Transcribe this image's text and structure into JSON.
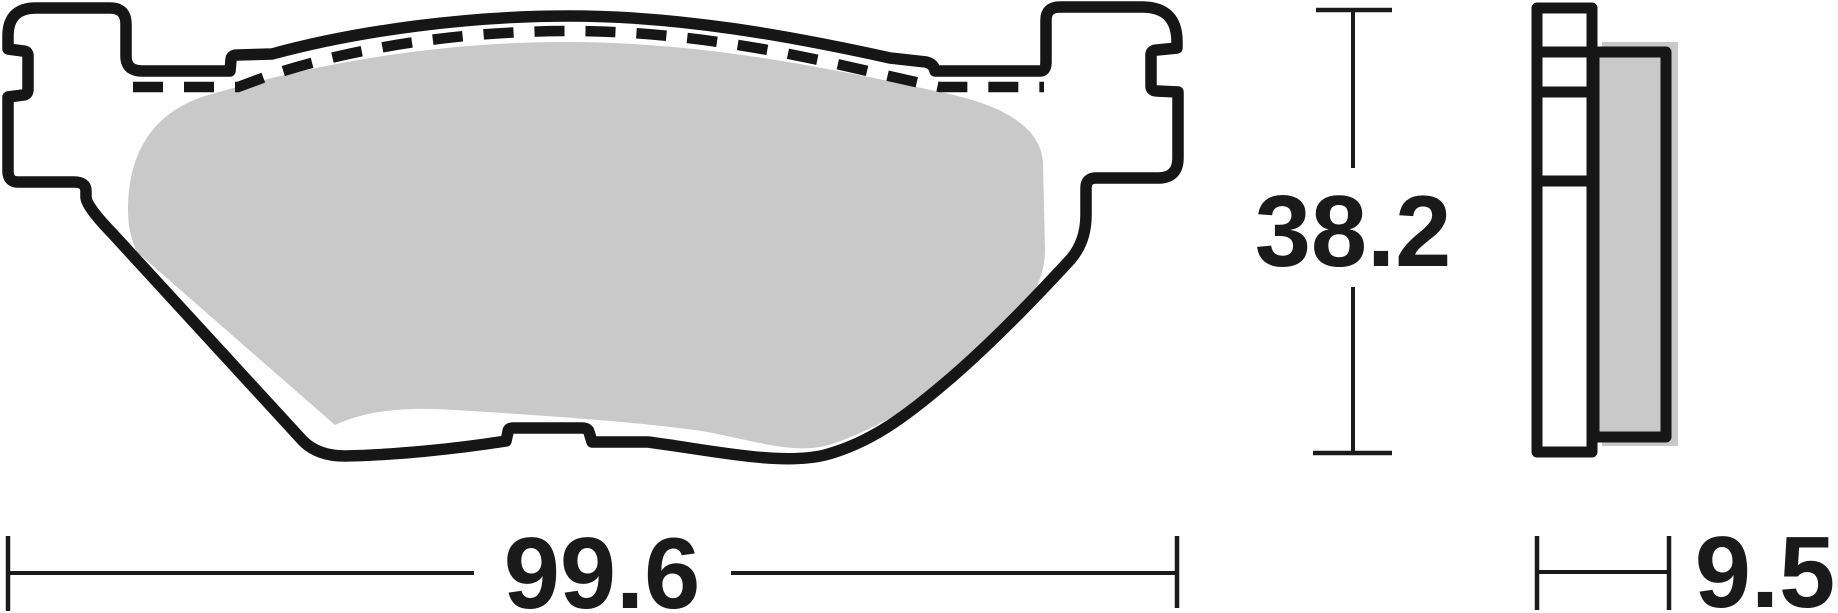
{
  "diagram": {
    "kind": "brake-pad-dimensional-drawing",
    "dimensions": {
      "width": {
        "label": "99.6"
      },
      "height": {
        "label": "38.2"
      },
      "thickness": {
        "label": "9.5"
      }
    },
    "colors": {
      "line": "#161616",
      "friction_fill": "#c9c9c9",
      "backplate_fill": "#ffffff",
      "background": "#ffffff"
    },
    "parts": {
      "front_view": "brake-pad-front-view",
      "side_view": "brake-pad-side-view",
      "backplate": "backplate-outline",
      "friction": "friction-material",
      "hidden_edge": "dashed-hidden-edge"
    }
  }
}
